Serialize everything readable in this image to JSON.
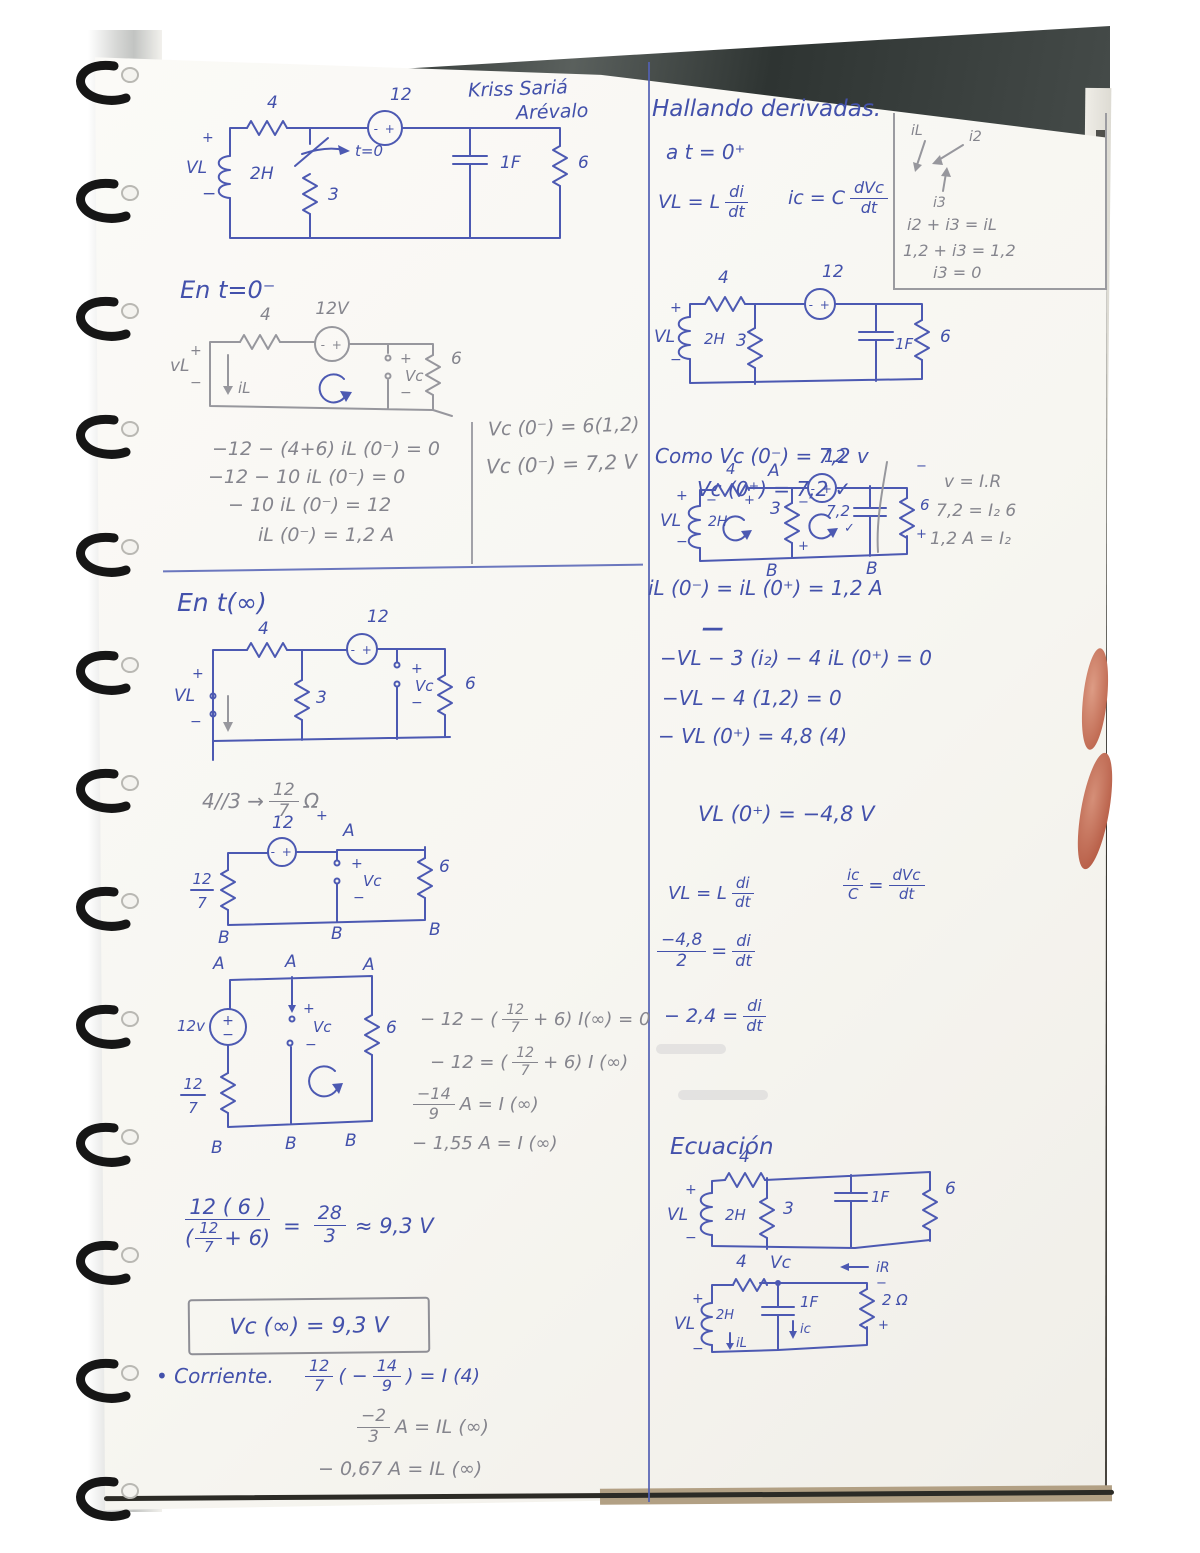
{
  "colors": {
    "ink": "#4351ab",
    "pencil": "#85858d",
    "paper": "#faf9f5"
  },
  "header": {
    "name1": "Kriss  Sariá",
    "name2": "Arévalo"
  },
  "left": {
    "c1": {
      "r_top": "4",
      "src_v": "12",
      "src": "- +",
      "plus": "+",
      "vl": "VL",
      "minus": "−",
      "ind": "2H",
      "sw": "t=0",
      "r_mid": "3",
      "cap": "1F",
      "r_right": "6"
    },
    "s2_title": "En t=0⁻",
    "c2": {
      "r_top": "4",
      "src_v": "12V",
      "src": "- +",
      "plus": "+",
      "vl": "vL",
      "minus": "−",
      "il": "iL",
      "vc_p": "+",
      "vc": "Vc",
      "vc_m": "−",
      "r_right": "6"
    },
    "eq2": {
      "l1": "−12 − (4+6) iL (0⁻)  = 0",
      "l2": "−12 − 10 iL (0⁻)  = 0",
      "l3": "− 10 iL (0⁻) = 12",
      "l4": "iL (0⁻) =  1,2 A"
    },
    "side2": {
      "l1": "Vc (0⁻) = 6(1,2)",
      "l2": "Vc (0⁻)  = 7,2 V"
    },
    "s3_title": "En t(∞)",
    "c3": {
      "r_top": "4",
      "src_v": "12",
      "src": "- +",
      "r_mid": "3",
      "vc_p": "+",
      "vc": "Vc",
      "vc_m": "−",
      "r_right": "6",
      "plus": "+",
      "vl": "VL",
      "minus": "−"
    },
    "par": {
      "pre": "4//3  →",
      "num": "12",
      "den": "7",
      "ohm": "Ω"
    },
    "c4": {
      "src_v": "12",
      "src": "- +",
      "stray_plus": "+",
      "a": "A",
      "num": "12",
      "den": "7",
      "vc_p": "+",
      "vc": "Vc",
      "vc_m": "−",
      "r_right": "6",
      "b1": "B",
      "b2": "B",
      "b3": "B"
    },
    "c5": {
      "a1": "A",
      "a2": "A",
      "a3": "A",
      "src_v": "12v",
      "src_p": "+",
      "src_m": "−",
      "num": "12",
      "den": "7",
      "vc_p": "+",
      "vc": "Vc",
      "vc_m": "−",
      "r_right": "6",
      "b1": "B",
      "b2": "B",
      "b3": "B"
    },
    "eq5": {
      "l1a": "− 12 − (",
      "l1n": "12",
      "l1d": "7",
      "l1b": "+ 6) I(∞) = 0",
      "l2a": "− 12 = (",
      "l2n": "12",
      "l2d": "7",
      "l2b": "+ 6) I (∞)",
      "l3n": "−14",
      "l3d": "9",
      "l3b": "A  =  I (∞)",
      "l4": "− 1,55 A  =  I (∞)"
    },
    "res": {
      "num": "12 ( 6 )",
      "den_a": "(",
      "den_n": "12",
      "den_d": "7",
      "den_b": "+ 6)",
      "eq": "=",
      "rn": "28",
      "rd": "3",
      "tail": "≈  9,3 V"
    },
    "box": "Vc (∞)  =  9,3 V",
    "cor": {
      "label": "• Corriente.",
      "e1n": "12",
      "e1d": "7",
      "e1a": "( −",
      "e1bn": "14",
      "e1bd": "9",
      "e1b": ") = I (4)",
      "e2n": "−2",
      "e2d": "3",
      "e2b": "A   = IL (∞)",
      "e3": "− 0,67 A = IL (∞)"
    }
  },
  "right": {
    "title": "Hallando derivadas.",
    "t0": "a   t = 0⁺",
    "f1": {
      "a": "VL = L",
      "n": "di",
      "d": "dt"
    },
    "f2": {
      "a": "ic = C",
      "n": "dVc",
      "d": "dt"
    },
    "kbox": {
      "il": "iL",
      "i2": "i2",
      "i3": "i3",
      "e1": "i2 + i3 = iL",
      "e2": "1,2 + i3  =  1,2",
      "e3": "i3  =  0"
    },
    "c6": {
      "r_top": "4",
      "src_v": "12",
      "src": "- +",
      "plus": "+",
      "vl": "VL",
      "minus": "−",
      "ind": "2H",
      "r_mid": "3",
      "cap": "1F",
      "r_right": "6"
    },
    "como": {
      "l1": "Como Vc (0⁻) = 7,2 v",
      "l2": "Vc (0⁺) = 7,2 ✓"
    },
    "c7": {
      "src_v": "12",
      "a": "A",
      "r_top": "4",
      "rm": "−",
      "rp": "+",
      "plus": "+",
      "vl": "VL",
      "minus": "−",
      "ind": "2H",
      "r_mid": "3",
      "mm": "−",
      "mp": "+",
      "src": "- +",
      "cap": "7,2",
      "chk": "✓",
      "r_right": "6",
      "em": "−",
      "ep": "+",
      "b1": "B",
      "b2": "B"
    },
    "law": {
      "l1": "v = I.R",
      "l2": "7,2 = I₂ 6",
      "l3": "1,2 A  =  I₂"
    },
    "il_line": "iL (0⁻) = iL (0⁺) =  1,2 A",
    "dash": "—",
    "eq7": {
      "l1": "−VL − 3 (i₂) − 4 iL (0⁺) = 0",
      "l2": "−VL −  4 (1,2)  = 0",
      "l3": "− VL (0⁺) = 4,8  (4)"
    },
    "vl_res": "VL (0⁺) =   −4,8 V",
    "f3": {
      "a": "VL = L",
      "n": "di",
      "d": "dt"
    },
    "f4": {
      "an": "ic",
      "ad": "C",
      "eq": "=",
      "n": "dVc",
      "d": "dt"
    },
    "f5": {
      "n": "−4,8",
      "d": "2",
      "eq": "=",
      "n2": "di",
      "d2": "dt"
    },
    "f6": {
      "a": "− 2,4  =",
      "n": "di",
      "d": "dt"
    },
    "ec_title": "Ecuación",
    "c8": {
      "r_top": "4",
      "plus": "+",
      "vl": "VL",
      "minus": "−",
      "ind": "2H",
      "r_mid": "3",
      "cap": "1F",
      "r_right": "6"
    },
    "c9": {
      "r_top": "4",
      "vc": "Vc",
      "ir": "iR",
      "rm": "−",
      "r_right": "2 Ω",
      "rp": "+",
      "cap": "1F",
      "ic": "ic",
      "plus": "+",
      "vl": "VL",
      "minus": "−",
      "ind": "2H",
      "il": "iL"
    }
  }
}
